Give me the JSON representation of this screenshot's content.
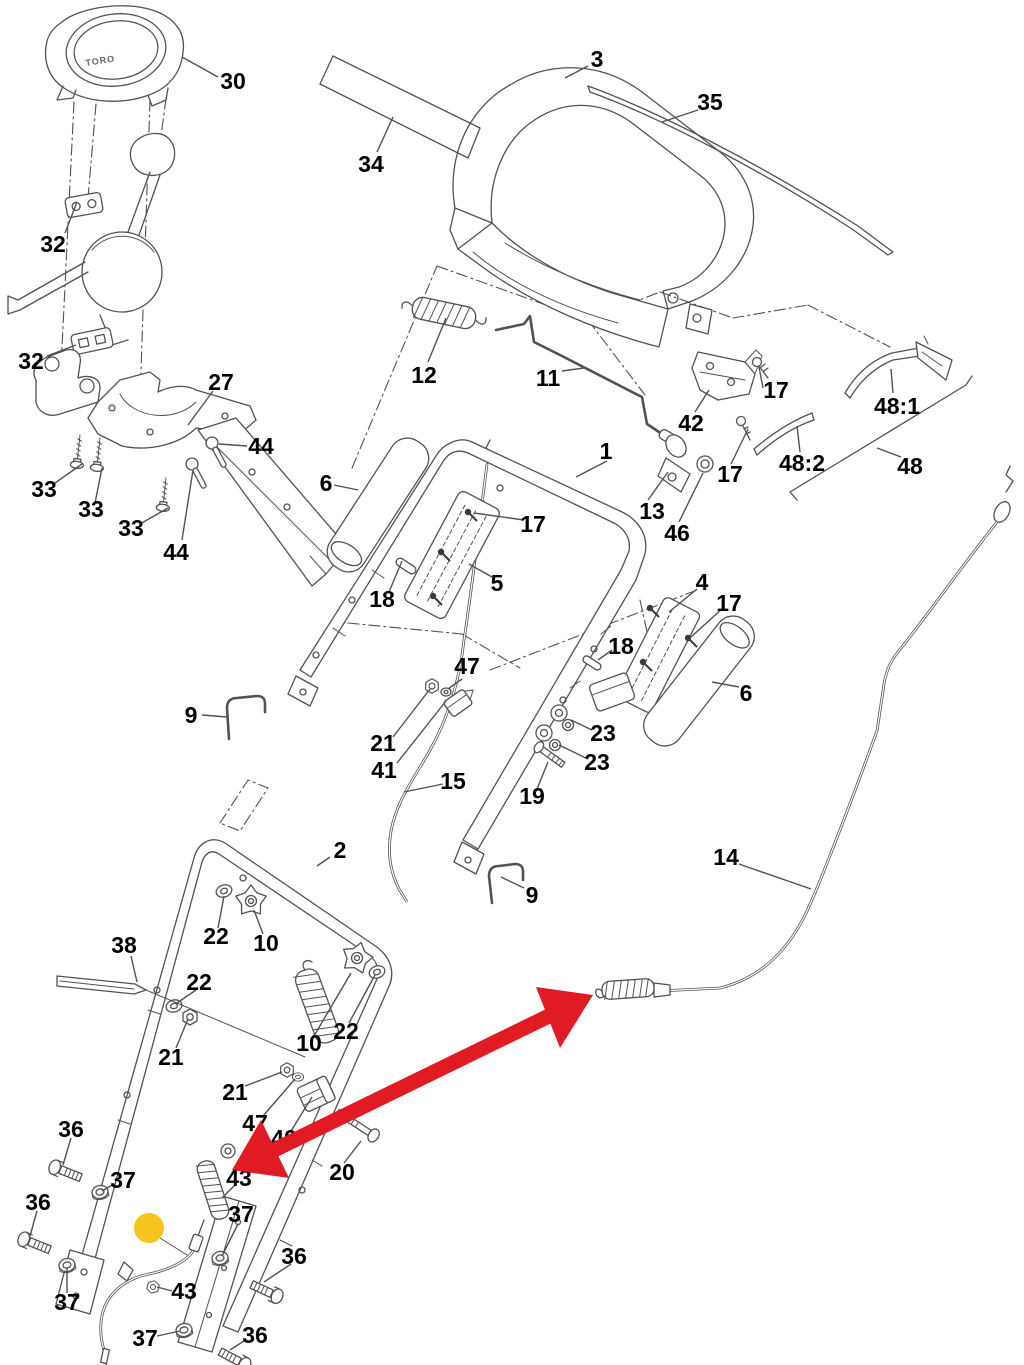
{
  "figure": {
    "type": "exploded-parts-diagram",
    "brand_text": "TORO",
    "background_color": "#ffffff",
    "line_color": "#525252",
    "label_color": "#000000",
    "label_font_size": 23
  },
  "annotations": {
    "red_arrow_color": "#e01b24",
    "highlight_color": "#f6c51d"
  },
  "part_labels": [
    {
      "text": "30",
      "x": 233,
      "y": 81,
      "leader": [
        218,
        77,
        182,
        57
      ]
    },
    {
      "text": "34",
      "x": 371,
      "y": 164,
      "leader": [
        377,
        152,
        393,
        117
      ]
    },
    {
      "text": "3",
      "x": 597,
      "y": 59,
      "leader": [
        588,
        66,
        565,
        78
      ]
    },
    {
      "text": "35",
      "x": 710,
      "y": 102,
      "leader": [
        698,
        110,
        662,
        122
      ]
    },
    {
      "text": "32",
      "x": 53,
      "y": 244,
      "leader": [
        65,
        233,
        77,
        202
      ]
    },
    {
      "text": "32",
      "x": 31,
      "y": 361,
      "leader": [
        47,
        356,
        76,
        345
      ]
    },
    {
      "text": "27",
      "x": 221,
      "y": 382,
      "leader": [
        213,
        391,
        188,
        425
      ]
    },
    {
      "text": "44",
      "x": 261,
      "y": 446,
      "leader": [
        247,
        446,
        219,
        444
      ]
    },
    {
      "text": "33",
      "x": 44,
      "y": 489,
      "leader": [
        55,
        483,
        82,
        464
      ]
    },
    {
      "text": "33",
      "x": 91,
      "y": 509,
      "leader": [
        95,
        503,
        102,
        468
      ]
    },
    {
      "text": "33",
      "x": 131,
      "y": 528,
      "leader": [
        140,
        524,
        168,
        508
      ]
    },
    {
      "text": "44",
      "x": 176,
      "y": 552,
      "leader": [
        182,
        540,
        193,
        470
      ]
    },
    {
      "text": "12",
      "x": 424,
      "y": 375,
      "leader": [
        428,
        362,
        446,
        318
      ]
    },
    {
      "text": "11",
      "x": 548,
      "y": 378,
      "leader": [
        562,
        371,
        584,
        368
      ]
    },
    {
      "text": "42",
      "x": 691,
      "y": 423,
      "leader": [
        695,
        412,
        709,
        390
      ]
    },
    {
      "text": "17",
      "x": 776,
      "y": 390,
      "leader": [
        763,
        388,
        759,
        367
      ]
    },
    {
      "text": "17",
      "x": 730,
      "y": 474,
      "leader": [
        731,
        464,
        748,
        429
      ]
    },
    {
      "text": "48:1",
      "x": 897,
      "y": 406,
      "leader": [
        893,
        393,
        891,
        369
      ]
    },
    {
      "text": "48:2",
      "x": 802,
      "y": 463,
      "leader": [
        800,
        452,
        797,
        426
      ]
    },
    {
      "text": "48",
      "x": 910,
      "y": 466,
      "leader": [
        901,
        457,
        877,
        448
      ]
    },
    {
      "text": "1",
      "x": 606,
      "y": 451,
      "leader": [
        607,
        461,
        576,
        477
      ]
    },
    {
      "text": "6",
      "x": 326,
      "y": 483,
      "leader": [
        334,
        485,
        358,
        490
      ]
    },
    {
      "text": "17",
      "x": 533,
      "y": 524,
      "leader": [
        524,
        520,
        474,
        513
      ]
    },
    {
      "text": "13",
      "x": 652,
      "y": 511,
      "leader": [
        648,
        500,
        668,
        472
      ]
    },
    {
      "text": "46",
      "x": 677,
      "y": 533,
      "leader": [
        679,
        522,
        703,
        473
      ]
    },
    {
      "text": "5",
      "x": 497,
      "y": 583,
      "leader": [
        492,
        577,
        469,
        564
      ]
    },
    {
      "text": "18",
      "x": 382,
      "y": 599,
      "leader": [
        389,
        592,
        402,
        561
      ]
    },
    {
      "text": "4",
      "x": 702,
      "y": 582,
      "leader": [
        697,
        589,
        669,
        612
      ]
    },
    {
      "text": "17",
      "x": 729,
      "y": 603,
      "leader": [
        723,
        608,
        691,
        637
      ]
    },
    {
      "text": "18",
      "x": 621,
      "y": 646,
      "leader": [
        612,
        650,
        598,
        660
      ]
    },
    {
      "text": "6",
      "x": 746,
      "y": 693,
      "leader": [
        739,
        687,
        712,
        682
      ]
    },
    {
      "text": "23",
      "x": 603,
      "y": 733,
      "leader": [
        592,
        730,
        571,
        720
      ]
    },
    {
      "text": "23",
      "x": 597,
      "y": 762,
      "leader": [
        588,
        759,
        559,
        745
      ]
    },
    {
      "text": "19",
      "x": 532,
      "y": 796,
      "leader": [
        537,
        789,
        548,
        762
      ]
    },
    {
      "text": "9",
      "x": 191,
      "y": 715,
      "leader": [
        202,
        715,
        227,
        717
      ]
    },
    {
      "text": "47",
      "x": 467,
      "y": 666,
      "leader": [
        462,
        679,
        448,
        689
      ]
    },
    {
      "text": "21",
      "x": 383,
      "y": 743,
      "leader": [
        393,
        737,
        430,
        689
      ]
    },
    {
      "text": "41",
      "x": 384,
      "y": 770,
      "leader": [
        397,
        763,
        446,
        701
      ]
    },
    {
      "text": "15",
      "x": 453,
      "y": 781,
      "leader": [
        443,
        784,
        404,
        792
      ]
    },
    {
      "text": "2",
      "x": 340,
      "y": 850,
      "leader": [
        330,
        857,
        317,
        866
      ]
    },
    {
      "text": "9",
      "x": 532,
      "y": 895,
      "leader": [
        524,
        888,
        501,
        877
      ]
    },
    {
      "text": "14",
      "x": 726,
      "y": 857,
      "leader": [
        739,
        864,
        811,
        889
      ]
    },
    {
      "text": "38",
      "x": 124,
      "y": 945,
      "leader": [
        131,
        956,
        137,
        982
      ]
    },
    {
      "text": "22",
      "x": 216,
      "y": 936,
      "leader": [
        218,
        928,
        224,
        896
      ]
    },
    {
      "text": "10",
      "x": 266,
      "y": 943,
      "leader": [
        263,
        934,
        254,
        910
      ]
    },
    {
      "text": "22",
      "x": 199,
      "y": 982,
      "leader": [
        196,
        990,
        177,
        1003
      ]
    },
    {
      "text": "21",
      "x": 171,
      "y": 1057,
      "leader": [
        176,
        1048,
        188,
        1019
      ]
    },
    {
      "text": "10",
      "x": 309,
      "y": 1043,
      "leader": [
        314,
        1036,
        351,
        973
      ]
    },
    {
      "text": "22",
      "x": 346,
      "y": 1031,
      "leader": [
        349,
        1023,
        375,
        975
      ]
    },
    {
      "text": "21",
      "x": 235,
      "y": 1092,
      "leader": [
        245,
        1086,
        282,
        1072
      ]
    },
    {
      "text": "47",
      "x": 255,
      "y": 1123,
      "leader": [
        263,
        1116,
        295,
        1079
      ]
    },
    {
      "text": "40",
      "x": 284,
      "y": 1138,
      "leader": [
        291,
        1131,
        312,
        1097
      ]
    },
    {
      "text": "20",
      "x": 342,
      "y": 1172,
      "leader": [
        344,
        1163,
        361,
        1141
      ]
    },
    {
      "text": "43",
      "x": 239,
      "y": 1178,
      "leader": [
        235,
        1185,
        222,
        1198
      ]
    },
    {
      "text": "37",
      "x": 241,
      "y": 1214,
      "leader": [
        238,
        1224,
        222,
        1256
      ]
    },
    {
      "text": "36",
      "x": 294,
      "y": 1256,
      "leader": [
        291,
        1264,
        264,
        1282
      ]
    },
    {
      "text": "36",
      "x": 71,
      "y": 1129,
      "leader": [
        71,
        1138,
        63,
        1165
      ]
    },
    {
      "text": "37",
      "x": 123,
      "y": 1180,
      "leader": [
        114,
        1184,
        102,
        1191
      ]
    },
    {
      "text": "36",
      "x": 38,
      "y": 1202,
      "leader": [
        37,
        1211,
        30,
        1236
      ]
    },
    {
      "text": "37",
      "x": 67,
      "y": 1302,
      "leader": [
        67,
        1293,
        67,
        1268
      ]
    },
    {
      "text": "43",
      "x": 184,
      "y": 1291,
      "leader": [
        172,
        1291,
        157,
        1287
      ]
    },
    {
      "text": "37",
      "x": 145,
      "y": 1338,
      "leader": [
        157,
        1336,
        180,
        1331
      ]
    },
    {
      "text": "36",
      "x": 255,
      "y": 1335,
      "leader": [
        244,
        1341,
        230,
        1350
      ]
    }
  ]
}
